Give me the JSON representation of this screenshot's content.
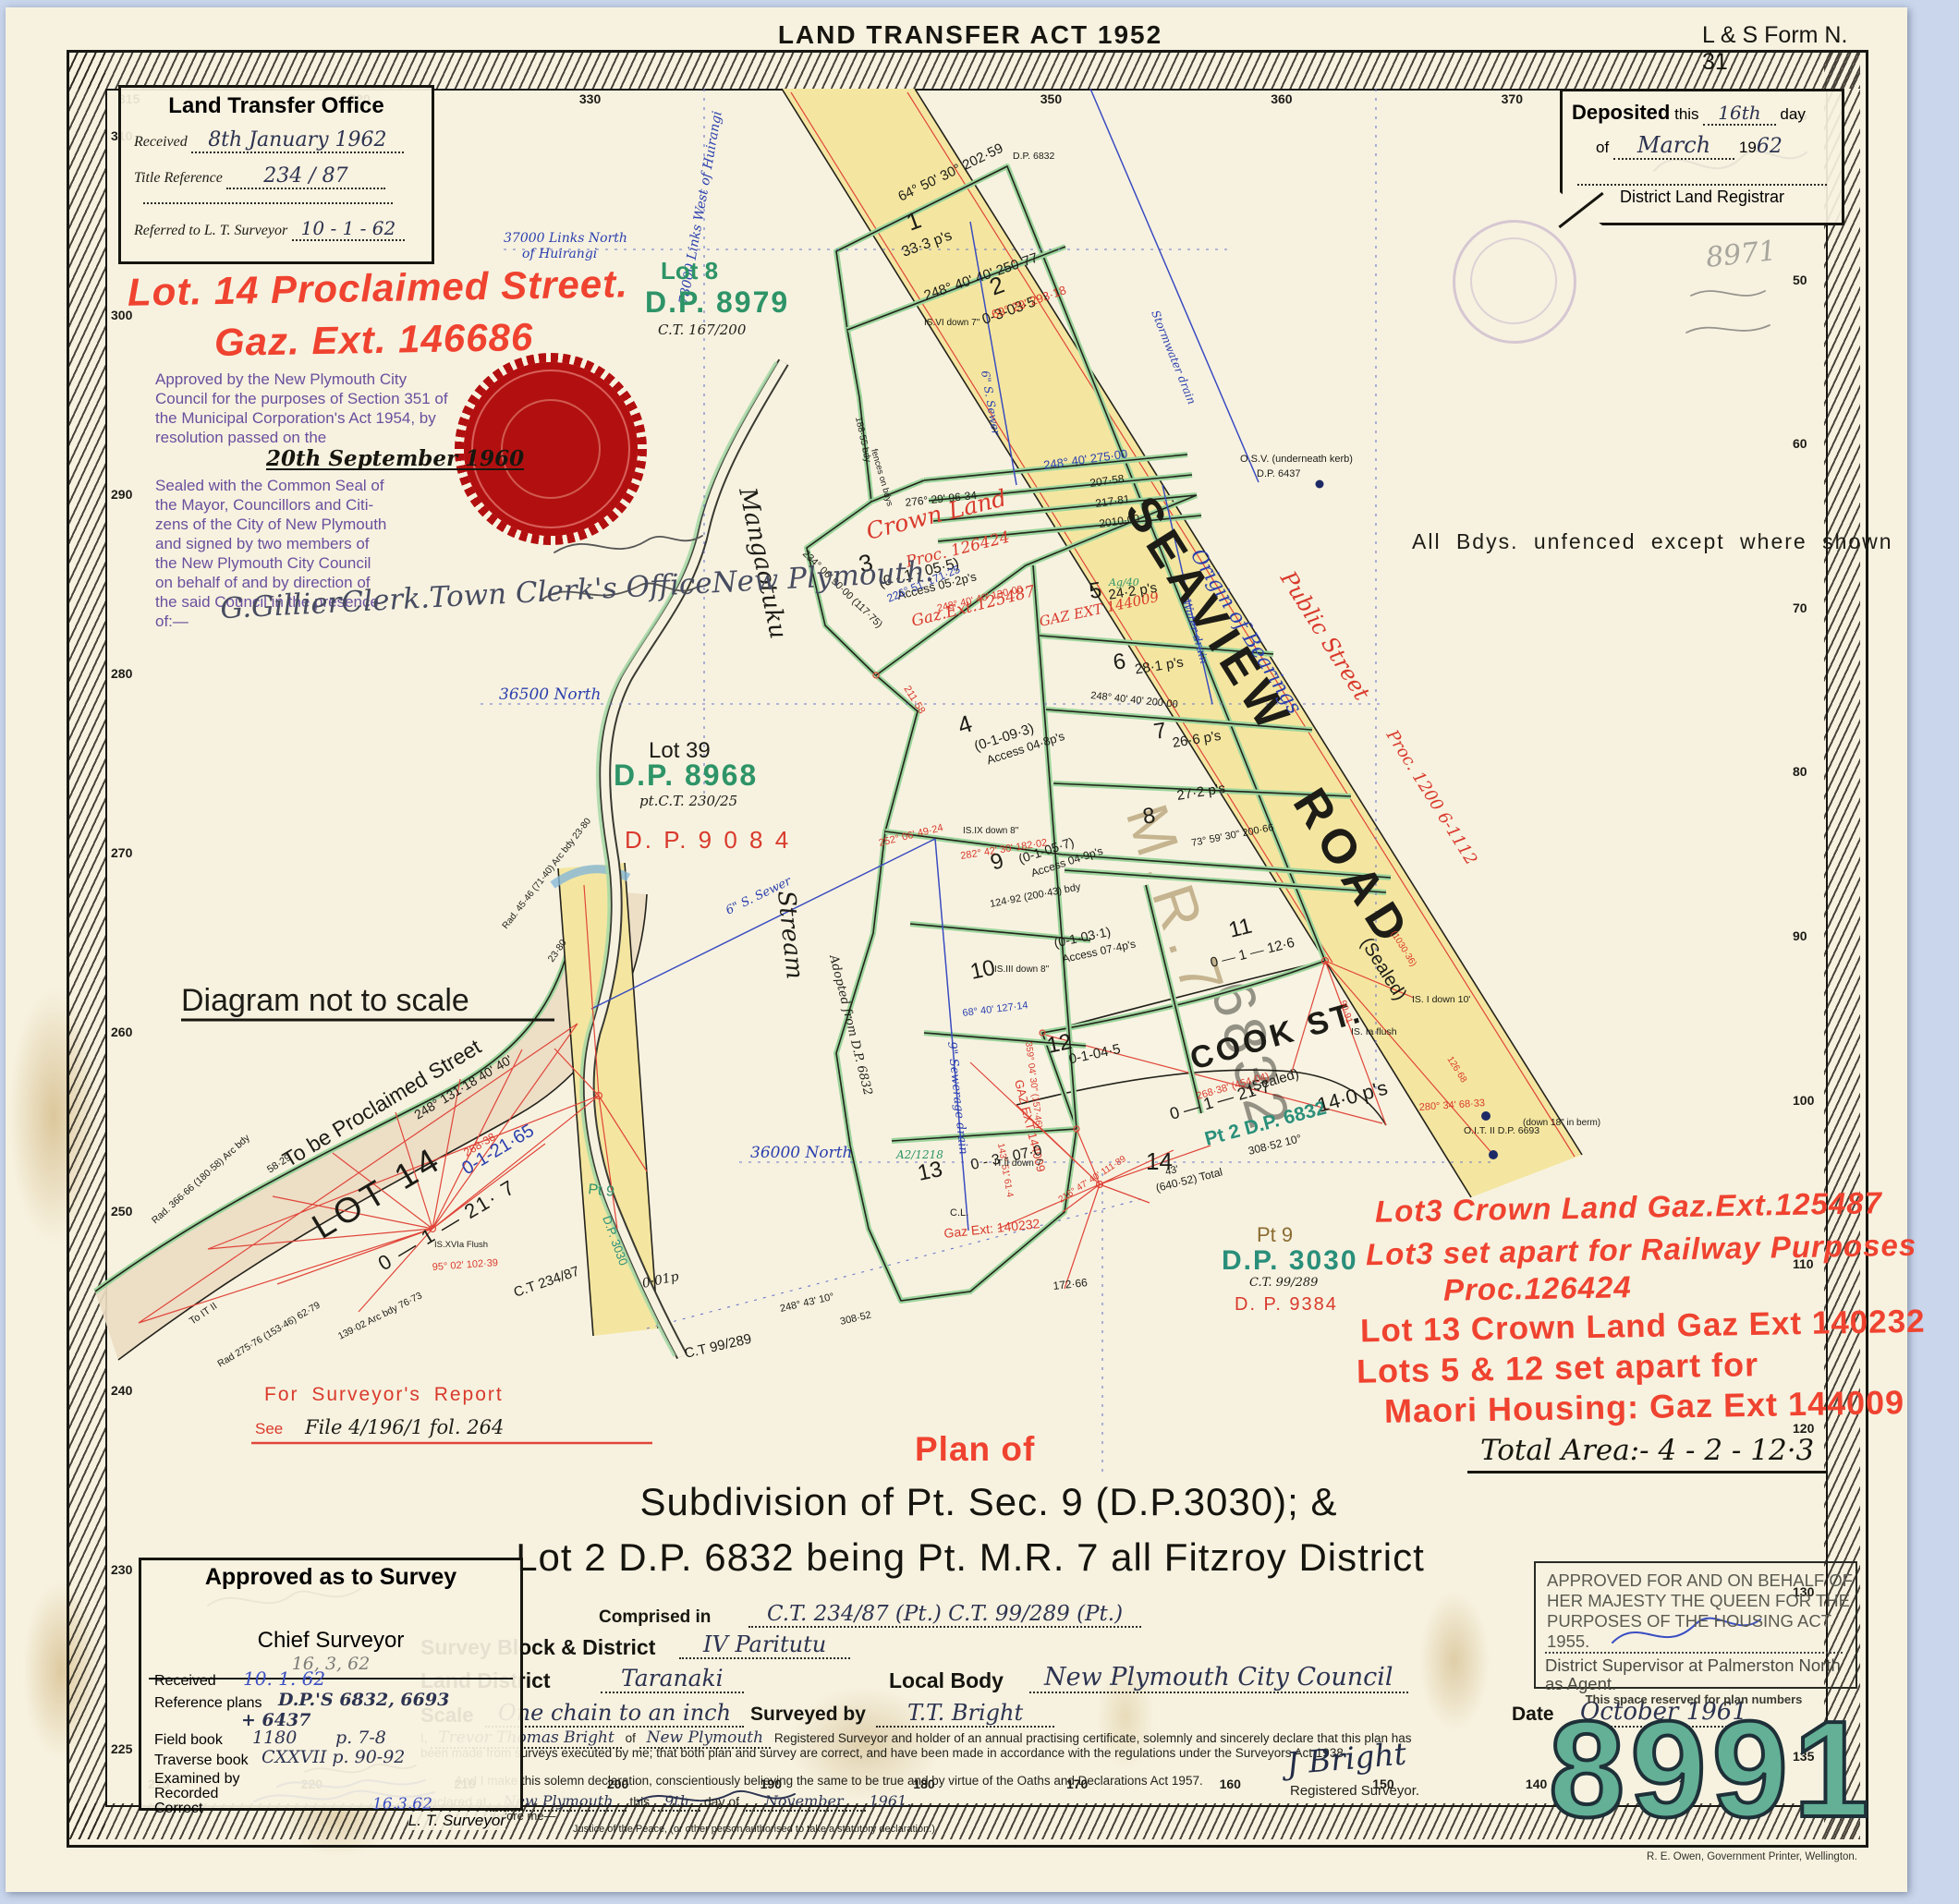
{
  "header": {
    "act": "LAND TRANSFER ACT 1952",
    "form_no": "L & S Form N. 31"
  },
  "lt_office": {
    "title": "Land Transfer Office",
    "received_label": "Received",
    "received_value": "8th  January 1962",
    "title_ref_label": "Title Reference",
    "title_ref_value": "234 / 87",
    "referred_label": "Referred to L. T. Surveyor",
    "referred_value": "10 - 1 - 62"
  },
  "deposited": {
    "deposited_label": "Deposited",
    "this_label": "this",
    "day_value": "16th",
    "day_label": "day",
    "of_label": "of",
    "month_value": "March",
    "year_prefix": "19",
    "year_value": "62",
    "registrar_label": "District Land Registrar"
  },
  "proclaimed": {
    "line1": "Lot. 14   Proclaimed   Street.",
    "line2": "Gaz. Ext. 146686"
  },
  "council": {
    "lines": [
      "Approved by the New Plymouth City",
      "Council for the purposes of Section 351 of",
      "the Municipal Corporation's Act 1954, by",
      "resolution passed on the"
    ],
    "resolution_date": "20th September 1960",
    "seal_lines": [
      "Sealed with the Common Seal of",
      "the Mayor, Councillors and Citi-",
      "zens of the City of New Plymouth",
      "and signed by two members of",
      "the New Plymouth City Council",
      "on behalf of and by direction of",
      "the said Council in the presence",
      "of:—"
    ]
  },
  "clerk": {
    "lines": [
      "G.Gillier",
      "Clerk.",
      "Town Clerk's Office",
      "New Plymouth."
    ]
  },
  "pencil_note": "8971",
  "red_notes": [
    "Lot3  Crown Land  Gaz.Ext.125487",
    "Lot3 set apart for Railway Purposes",
    "Proc.126424",
    "Lot 13 Crown Land Gaz Ext 140232",
    "Lots 5 & 12 set apart for",
    "Maori Housing: Gaz Ext 144009"
  ],
  "title_block": {
    "plan_of": "Plan of",
    "line1": "Subdivision    of    Pt. Sec. 9 (D.P.3030); &",
    "line2": "Lot 2   D.P. 6832  being  Pt. M.R. 7   all   Fitzroy   District",
    "comprised_label": "Comprised in",
    "comprised_value": "C.T. 234/87 (Pt.)   C.T. 99/289 (Pt.)",
    "total_area": "Total Area:- 4 - 2 - 12·3"
  },
  "form": {
    "survey_block_label": "Survey Block & District",
    "survey_block_value": "IV   Paritutu",
    "land_district_label": "Land District",
    "land_district_value": "Taranaki",
    "local_body_label": "Local Body",
    "local_body_value": "New Plymouth City Council",
    "scale_label": "Scale",
    "scale_value": "One chain to an inch",
    "surveyed_label": "Surveyed by",
    "surveyed_value": "T.T. Bright",
    "date_label": "Date",
    "date_value": "October 1961",
    "decl_i": "I,",
    "decl_name": "Trevor Thomas Bright",
    "decl_of": "of",
    "decl_place": "New Plymouth",
    "decl_body": "Registered Surveyor and holder of an annual practising certificate, solemnly and sincerely declare that this plan has been made from surveys executed by me; that both plan and survey are correct, and have been made in accordance with the regulations under the Surveyors Act 1938.",
    "decl_body2": "And I make this solemn declaration, conscientiously believing the same to be true and by virtue of the Oaths and Declarations Act 1957.",
    "declared_label": "Declared at",
    "declared_place": "New  Plymouth",
    "this_label": "this",
    "day_value": "9th",
    "day_of_label": "day of",
    "month_value": "November",
    "year_value": "1961.",
    "before_label": "before me—",
    "jp_label": "Justice of the Peace, (or other person authorised to take a statutory declaration.)",
    "sig": "J Bright",
    "sig_label": "Registered Surveyor."
  },
  "approved": {
    "title": "Approved as to Survey",
    "chief_label": "Chief Surveyor",
    "chief_date": "16, 3, 62",
    "received_label": "Received",
    "received_value": "10.  1.  62",
    "ref_label": "Reference plans",
    "ref_value": "D.P.'S 6832, 6693",
    "ref_value2": "+ 6437",
    "field_label": "Field book",
    "field_value": "1180",
    "field_pages": "p. 7-8",
    "traverse_label": "Traverse book",
    "traverse_value": "CXXVII  p. 90-92",
    "examined_label": "Examined by",
    "recorded_label": "Recorded",
    "correct_label": "Correct",
    "correct_date": "16.3.62",
    "lt_label": "L. T. Surveyor"
  },
  "housing": {
    "lines": [
      "APPROVED FOR AND ON BEHALF OF",
      "HER MAJESTY THE QUEEN FOR THE",
      "PURPOSES OF THE HOUSING ACT, 1955."
    ],
    "agent_line1": "District Supervisor at Palmerston North",
    "agent_line2": "as Agent.",
    "reserved_label": "This space reserved for plan numbers",
    "plan_number": "8991"
  },
  "printer": "R. E. Owen, Government Printer, Wellington.",
  "rulers": {
    "top": [
      "315",
      "320",
      "330",
      "340",
      "350",
      "360",
      "370"
    ],
    "left": [
      "310",
      "300",
      "290",
      "280",
      "270",
      "260",
      "250",
      "240",
      "230",
      "225"
    ],
    "right": [
      "45",
      "50",
      "60",
      "70",
      "80",
      "90",
      "100",
      "110",
      "120",
      "130",
      "135"
    ],
    "bottom": [
      "225",
      "220",
      "210",
      "200",
      "190",
      "180",
      "170",
      "160",
      "150",
      "140",
      "135"
    ]
  },
  "map": {
    "seaview": {
      "name": "SEAVIEW",
      "name2": "ROAD",
      "sealed": "(Sealed)",
      "origin": "Origin of Bearings",
      "public_street": "Public Street",
      "proc": "Proc. 1200  6-1112"
    },
    "cook": {
      "name": "COOK ST.",
      "sealed": "(Sealed)",
      "area": "0 — 1 — 21·7",
      "chainage": "268·38'  (454·04)",
      "pt2": "Pt 2  D.P. 6832",
      "pt2_area": "14·0 p's"
    },
    "stream": {
      "name1": "Mangaotuku",
      "name2": "Stream",
      "adopted": "Adopted  from  D.P. 6832"
    },
    "grid": {
      "n36500": "36500 North",
      "n36000": "36000 North",
      "links_north1": "37000 Links North",
      "links_north2": "of Huirangi",
      "links_west": "78000 Links West of Huirangi"
    },
    "stamps": {
      "lot8": "Lot 8",
      "dp8979": "D.P. 8979",
      "ct167": "C.T. 167/200",
      "lot39": "Lot 39",
      "dp8968": "D.P. 8968",
      "ct230": "pt.C.T. 230/25",
      "dp9084": "D. P.  9 0 8 4",
      "pt9": "Pt 9",
      "dp3030": "D.P. 3030",
      "ct99": "C.T. 99/289",
      "dp9384": "D. P. 9384",
      "p001": "0·01p"
    },
    "notes": {
      "unfenced": "All  Bdys.  unfenced  except  where  shown",
      "not_to_scale": "Diagram not to scale",
      "proclaim": "To be Proclaimed Street",
      "lot14": "LOT  14",
      "lot14_area_blue": "0-1-21·65",
      "lot14_area": "0 — 1 — 21· 7",
      "crown": "Crown Land",
      "crown_proc": "Proc.  126424",
      "gaz125487": "Gaz.Ext.125487",
      "gaz144009": "GAZ EXT 144009",
      "gaz140232": "Gaz Ext: 140232",
      "cl": "C.L.",
      "ag40": "Ag/40",
      "a2": "A2/1218",
      "report1": "For   Surveyor's   Report",
      "report2": "See",
      "report_file": "File 4/196/1 fol. 264"
    },
    "drains": {
      "sewer6": "6\" S. Sewer",
      "sewer9": "9\" Sewerage drain",
      "storm": "Stormwater drain",
      "water": "Water drain"
    },
    "ghosts": {
      "mr7": "M.R.7",
      "dp6832": "6832"
    },
    "lots": [
      {
        "n": "1",
        "a": "33·3 p's",
        "e": ""
      },
      {
        "n": "2",
        "a": "0-3-03·5",
        "e": ""
      },
      {
        "n": "3",
        "a": "(0 - 1 - 05·5)",
        "e": "Access 05·2p's"
      },
      {
        "n": "4",
        "a": "(0-1-09·3)",
        "e": "Access 04·8p's"
      },
      {
        "n": "5",
        "a": "24·2 p's",
        "e": ""
      },
      {
        "n": "6",
        "a": "28·1 p's",
        "e": ""
      },
      {
        "n": "7",
        "a": "26·6 p's",
        "e": ""
      },
      {
        "n": "8",
        "a": "27·2 p's",
        "e": ""
      },
      {
        "n": "9",
        "a": "(0-1-05·7)",
        "e": "Access 04·9p's"
      },
      {
        "n": "10",
        "a": "(0-1-03·1)",
        "e": "Access 07·4p's"
      },
      {
        "n": "11",
        "a": "0 — 1 — 12·6",
        "e": ""
      },
      {
        "n": "12",
        "a": "0-1-04·5",
        "e": ""
      },
      {
        "n": "13",
        "a": "0 - 3 - 07·0",
        "e": ""
      },
      {
        "n": "14",
        "a": "",
        "e": ""
      }
    ],
    "annos": [
      "64°  50'  30°   202·59",
      "248°  40'  40'   250·77",
      "69°  29'   293·18",
      "248°  40'   275·00",
      "207·58",
      "217·81",
      "2010·00",
      "276° 29'   96·34",
      "234° 06'  90·00  (117·75)",
      "226° 51'   171·25",
      "211·58",
      "248° 40' 40'   130·00",
      "248°  40'  40'   200·00",
      "73° 59' 30\"   200·66",
      "282° 42' 30'   182·02",
      "252° 06'   49·24",
      "124·92   (200·43) bdy",
      "68°  40'   127·14",
      "359° 04' 30\"  (157·46)",
      "143° 51'   61·4",
      "216° 47' 40'   111·89",
      "172·66",
      "188·55 bdy",
      "fences on bdys",
      "(640·52) Total",
      "308·52    10°",
      "43'",
      "280° 34'   68·33",
      "90·91",
      "(1030·36)",
      "126·68",
      "58·29",
      "248°   131·18   40'   40'",
      "268·38",
      "95° 02'   102·39",
      "Rad. 366·66  (180·58)  Arc bdy",
      "To IT II",
      "139·02   Arc bdy   76·73",
      "Rad 275·76  (153·46)   62·79",
      "23·80",
      "Rad. 45·46  (71·40)  Arc bdy  23·80",
      "IS.XVIa  Flush",
      "C.T  234/87",
      "C.T  99/289",
      "IS. I   down 10'",
      "IS. Ia   flush",
      "O.I.T. II    D.P. 6693",
      "(down 18\"  in berm)",
      "O.S.V. (underneath kerb)",
      "D.P. 6437",
      "D.P. 6832",
      "IS.VI  down 7\"",
      "IS.IX  down 8\"",
      "IS.III  down 8\"",
      "IT.II  down 7'",
      "248°    43'    10°",
      "308·52"
    ]
  }
}
